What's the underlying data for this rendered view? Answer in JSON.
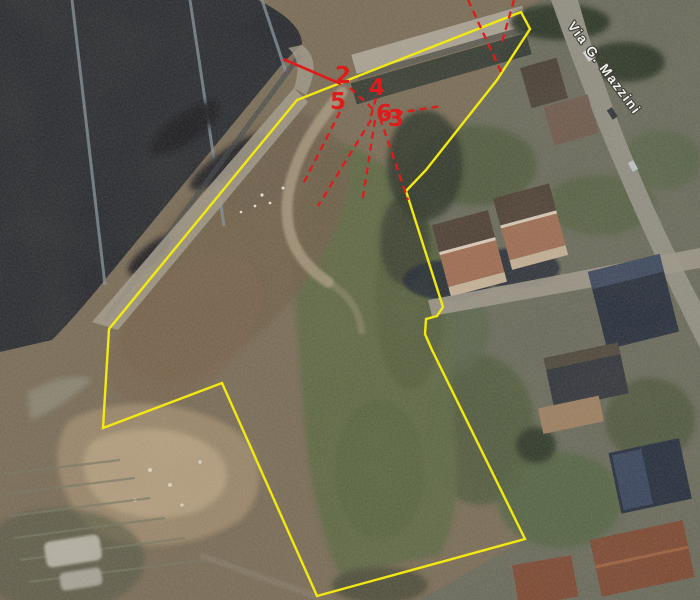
{
  "map": {
    "street_label": "Via G. Mazzini",
    "colors": {
      "boundary": "#f2e912",
      "annotation": "#dd1c1c",
      "street_text": "#f2f1ec",
      "street_text_outline": "#3a3a36"
    },
    "boundary_points": "521,12 530,29 497,80 426,170 406,191 443,307 437,316 426,319 425,334 432,350 525,539 317,596 222,383 103,428 109,329 297,100",
    "viewpoints": [
      {
        "label": "2",
        "x": 343,
        "y": 83
      },
      {
        "label": "4",
        "x": 377,
        "y": 95
      },
      {
        "label": "5",
        "x": 338,
        "y": 109
      },
      {
        "label": "6",
        "x": 384,
        "y": 121
      },
      {
        "label": "3",
        "x": 396,
        "y": 126
      }
    ],
    "view_lines": [
      {
        "x1": 468,
        "y1": 0,
        "x2": 503,
        "y2": 76,
        "dashed": true
      },
      {
        "x1": 514,
        "y1": 0,
        "x2": 502,
        "y2": 42,
        "dashed": true
      },
      {
        "x1": 283,
        "y1": 59,
        "x2": 341,
        "y2": 84,
        "dashed": false
      },
      {
        "x1": 384,
        "y1": 115,
        "x2": 442,
        "y2": 106,
        "dashed": true
      },
      {
        "x1": 380,
        "y1": 118,
        "x2": 408,
        "y2": 200,
        "dashed": true
      },
      {
        "x1": 375,
        "y1": 120,
        "x2": 362,
        "y2": 203,
        "dashed": true
      },
      {
        "x1": 371,
        "y1": 120,
        "x2": 318,
        "y2": 206,
        "dashed": true
      },
      {
        "x1": 340,
        "y1": 112,
        "x2": 303,
        "y2": 184,
        "dashed": true
      },
      {
        "x1": 350,
        "y1": 88,
        "x2": 373,
        "y2": 109,
        "dashed": true
      },
      {
        "x1": 376,
        "y1": 98,
        "x2": 371,
        "y2": 116,
        "dashed": true
      }
    ]
  }
}
